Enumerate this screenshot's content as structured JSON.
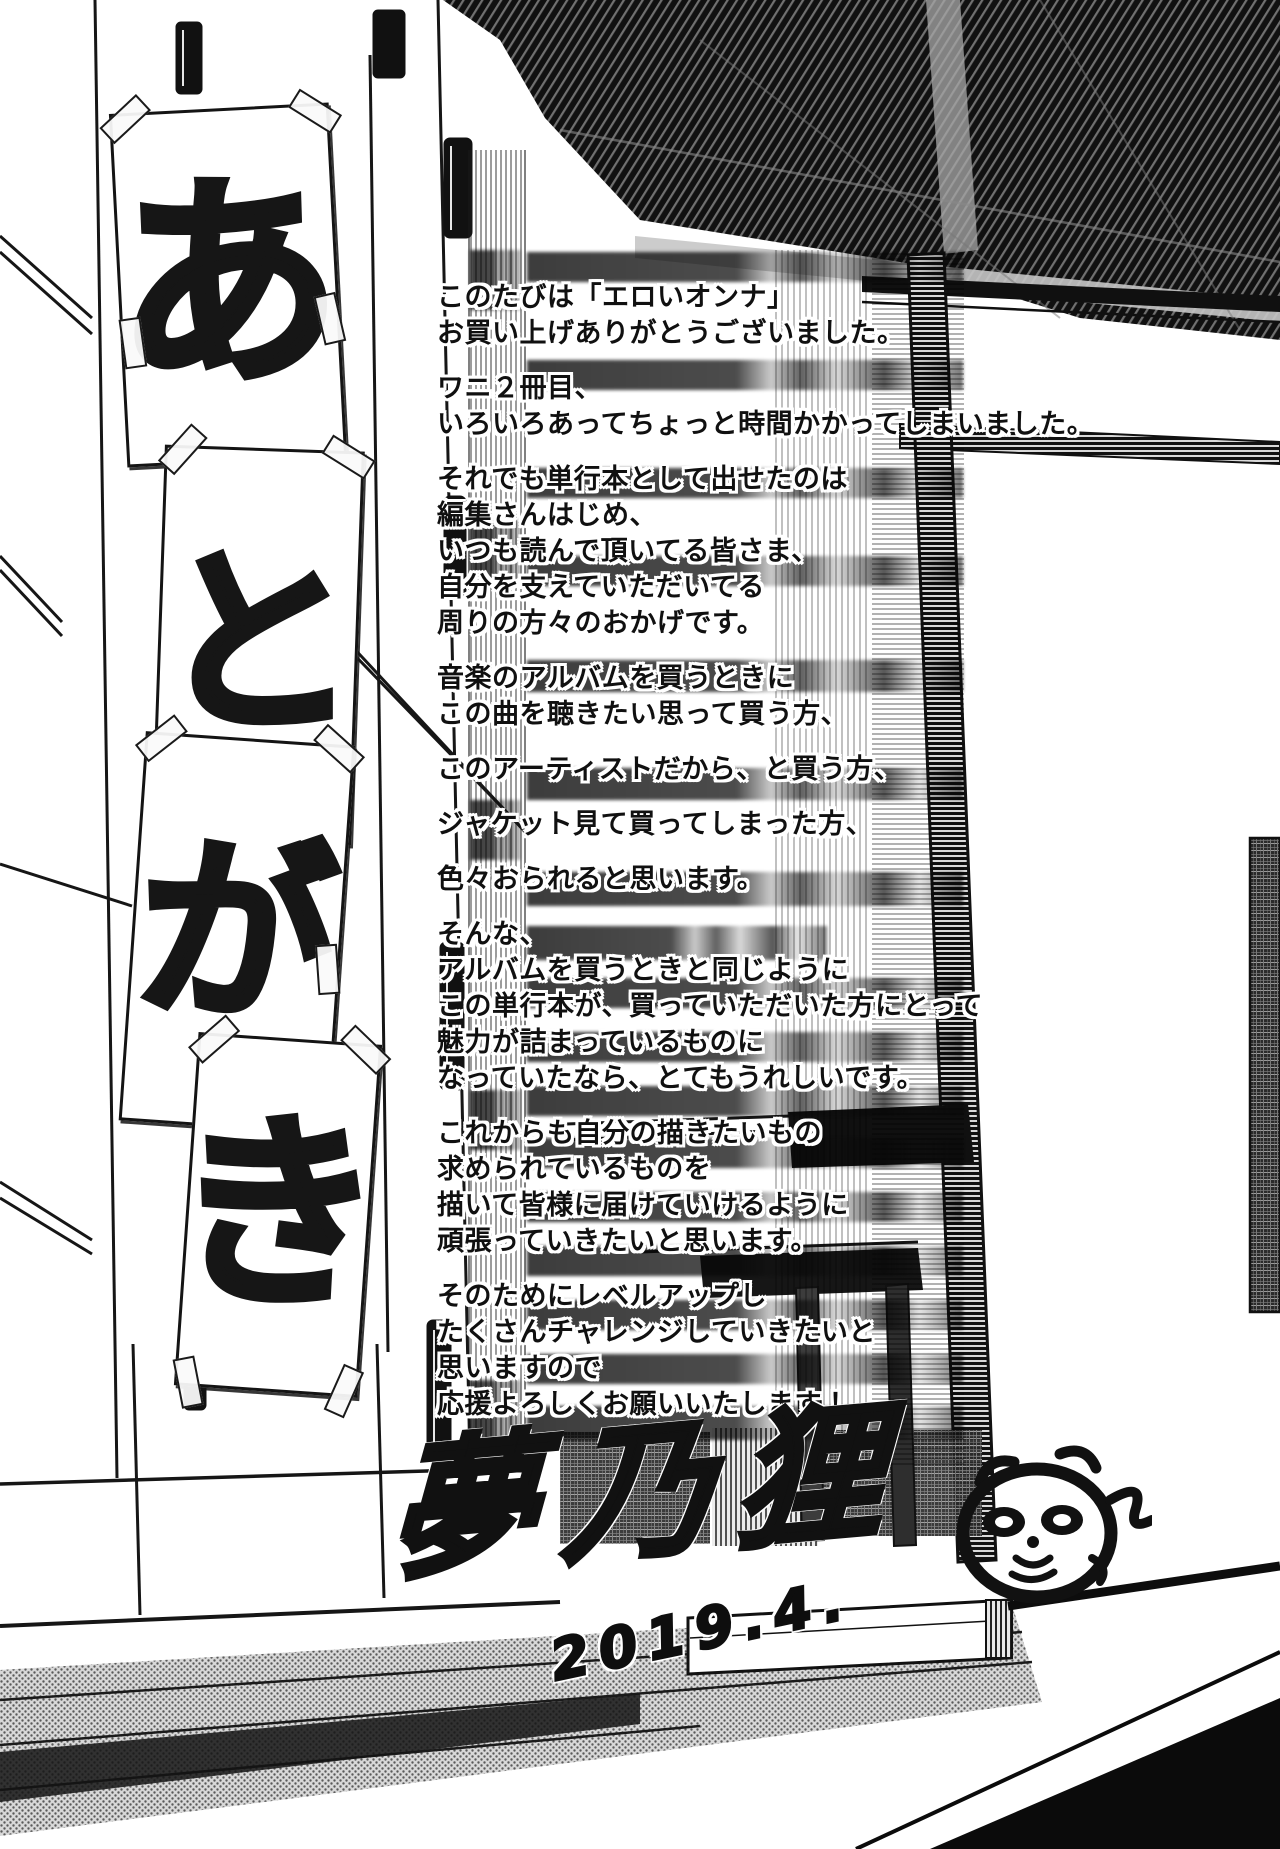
{
  "signs_word": "あとがき",
  "signs": [
    {
      "char": "あ"
    },
    {
      "char": "と"
    },
    {
      "char": "が"
    },
    {
      "char": "き"
    }
  ],
  "afterword_lines": [
    "このたびは「エロいオンナ」",
    "お買い上げありがとうございました。",
    "ワニ２冊目、",
    "いろいろあってちょっと時間かかってしまいました。",
    "それでも単行本として出せたのは",
    "編集さんはじめ、",
    "いつも読んで頂いてる皆さま、",
    "自分を支えていただいてる",
    "周りの方々のおかげです。",
    "音楽のアルバムを買うときに",
    "この曲を聴きたい思って買う方、",
    "このアーティストだから、と買う方、",
    "ジャケット見て買ってしまった方、",
    "色々おられると思います。",
    "そんな、",
    "アルバムを買うときと同じように",
    "この単行本が、買っていただいた方にとって",
    "魅力が詰まっているものに",
    "なっていたなら、とてもうれしいです。",
    "これからも自分の描きたいもの",
    "求められているものを",
    "描いて皆様に届けていけるように",
    "頑張っていきたいと思います。",
    "そのためにレベルアップし",
    "たくさんチャレンジしていきたいと",
    "思いますので",
    "応援よろしくお願いいたします！"
  ],
  "signature": {
    "artist": "夢乃狸",
    "date": "2019.4."
  }
}
